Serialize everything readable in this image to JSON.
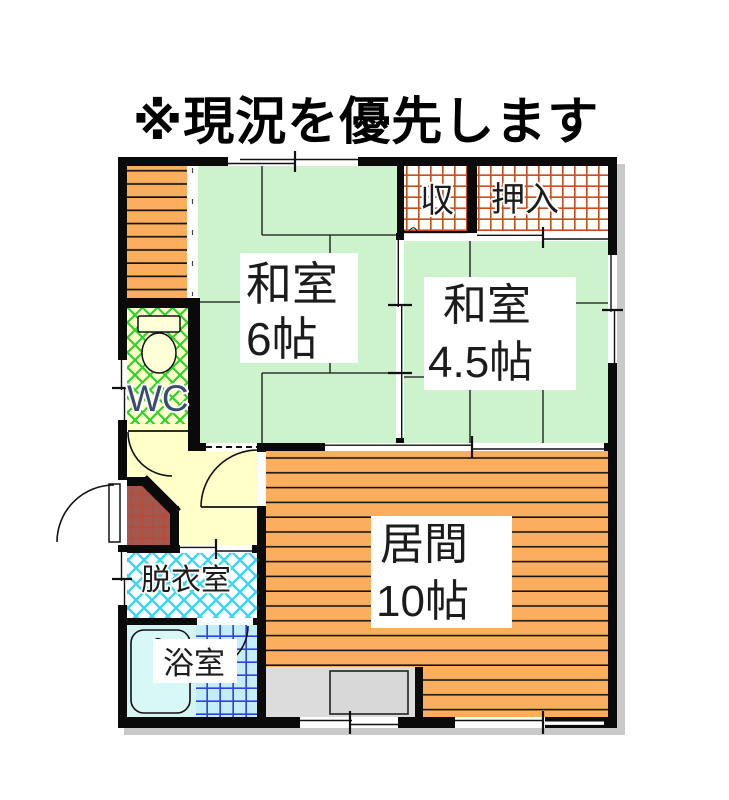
{
  "title": "※現況を優先します",
  "rooms": {
    "washitsu6": {
      "line1": "和室",
      "line2": "6帖",
      "floor": "tatami"
    },
    "washitsu45": {
      "line1": "和室",
      "line2": "4.5帖",
      "floor": "tatami"
    },
    "living": {
      "line1": "居間",
      "line2": "10帖",
      "floor": "wood"
    },
    "storage": {
      "label": "収"
    },
    "closet": {
      "label": "押入"
    },
    "toilet": {
      "label": "WC"
    },
    "dressing": {
      "label": "脱衣室"
    },
    "bath": {
      "label": "浴室"
    }
  },
  "colors": {
    "tatami_green": "#cdf3cd",
    "wood_orange": "#fbaf5e",
    "hall_cream": "#ffffc8",
    "closet_grid_red": "#c8501e",
    "wc_lattice_green": "#2ed22e",
    "dressing_lattice_cyan": "#3cd8e8",
    "bath_tile_blue": "#2b46d8",
    "bath_floor_cyan": "#d4f4f4",
    "entrance_tile_brown": "#a2584c",
    "kitchen_gray": "#dcdcdc",
    "wall_black": "#0a0a0a",
    "wc_text_blue": "#3d4c6e"
  }
}
